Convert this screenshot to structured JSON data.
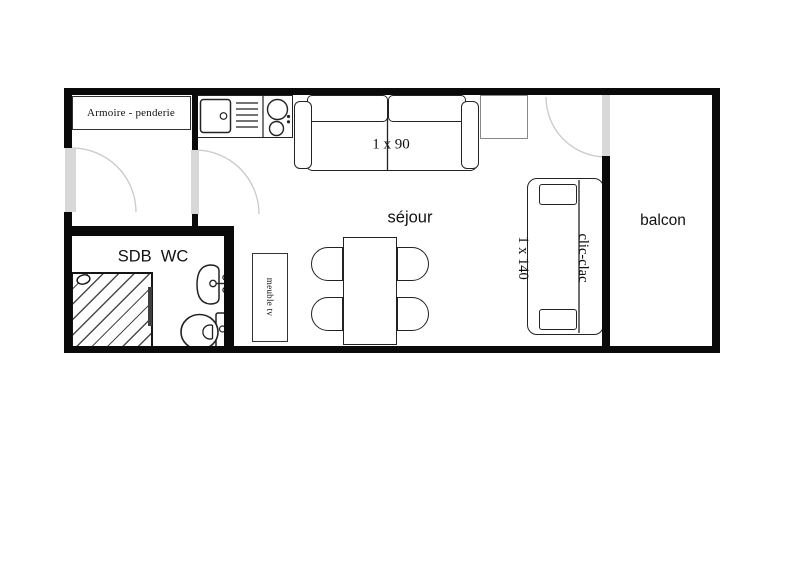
{
  "floorplan": {
    "rooms": {
      "wardrobe_label": "Armoire - penderie",
      "bathroom_label": "SDB  WC",
      "living_label": "séjour",
      "balcony_label": "balcon"
    },
    "furniture": {
      "bed_label": "1 x 90",
      "sofa_label_line1": "clic-clac",
      "sofa_label_line2": "1 x 140",
      "tv_label": "meuble tv"
    },
    "colors": {
      "wall": "#0a0a0a",
      "door_leaf": "#d8d8d8",
      "door_arc": "#c9c9c9",
      "furniture_line": "#222222"
    }
  }
}
